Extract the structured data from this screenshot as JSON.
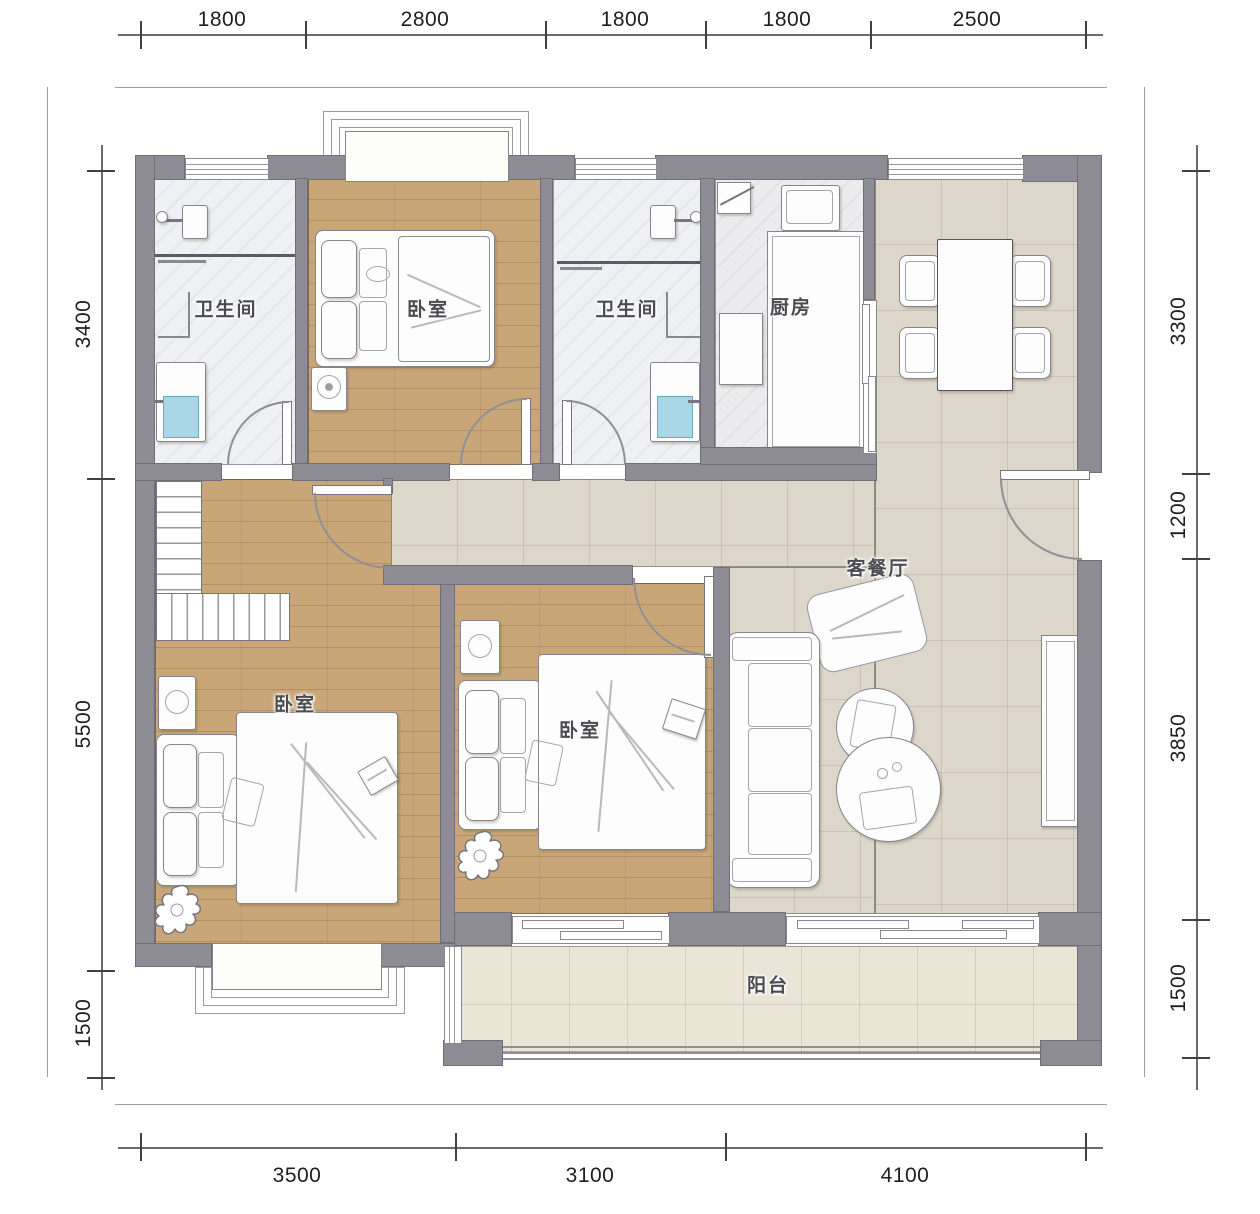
{
  "rooms": {
    "bath1": "卫生间",
    "bed_top": "卧室",
    "bath2": "卫生间",
    "kitchen": "厨房",
    "living": "客餐厅",
    "bed_left": "卧室",
    "bed_mid": "卧室",
    "balcony": "阳台"
  },
  "dimensions": {
    "top": [
      "1800",
      "2800",
      "1800",
      "1800",
      "2500"
    ],
    "bottom": [
      "3500",
      "3100",
      "4100"
    ],
    "left": [
      "3400",
      "5500",
      "1500"
    ],
    "right": [
      "3300",
      "1200",
      "3850",
      "1500"
    ]
  },
  "colors": {
    "wall": "#8d8b93",
    "wood_floor": "#c8a678",
    "tile_floor": "#ddd7cb",
    "balcony_floor": "#eae5d6",
    "bath_floor": "#eef0f3",
    "washer_blue": "#a9d7e8"
  }
}
